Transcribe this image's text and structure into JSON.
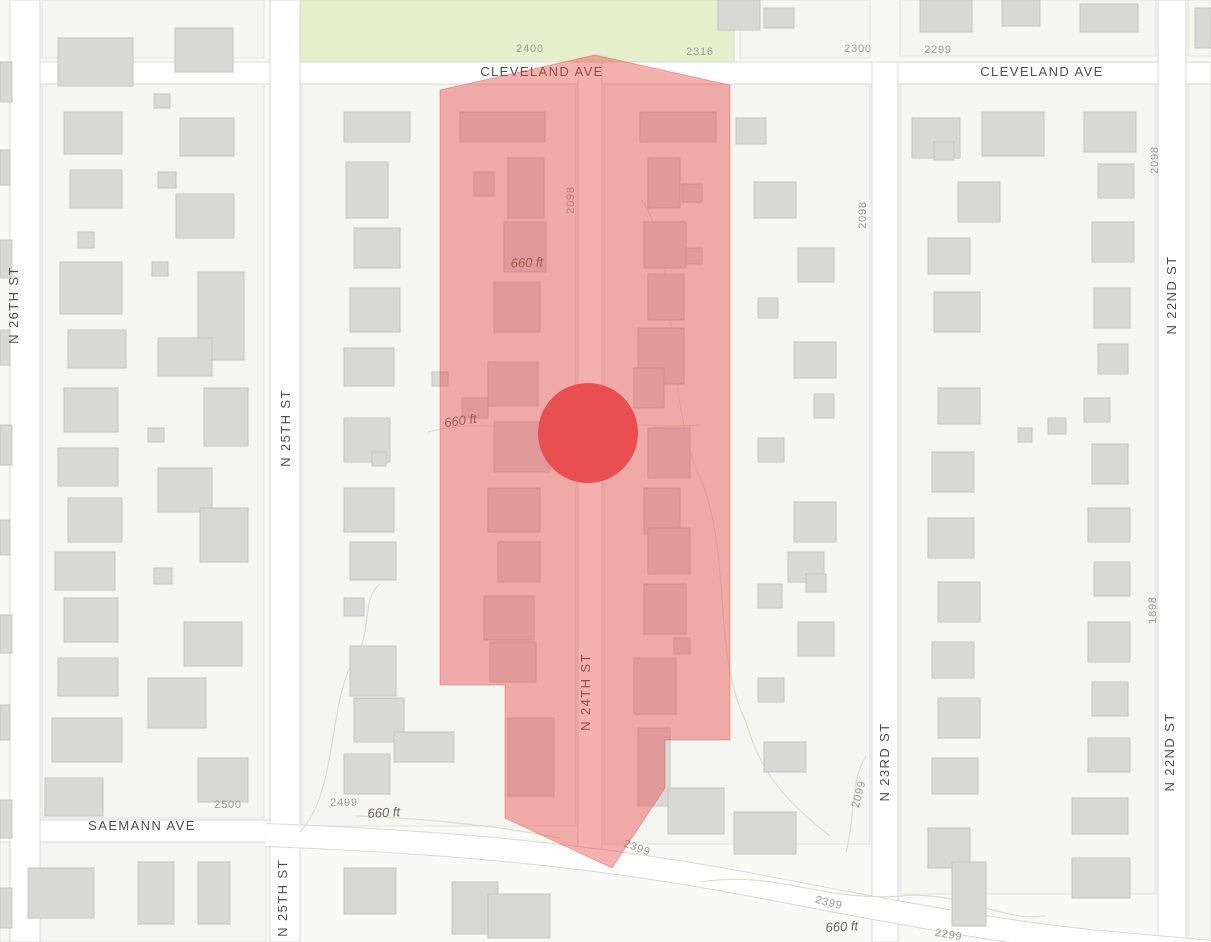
{
  "map": {
    "title": "parcel-map-viewport",
    "width": 1211,
    "height": 942,
    "colors": {
      "background": "#f9f9f6",
      "block_fill": "#f5f5f1",
      "block_border": "#e1e1dd",
      "street_fill": "#ffffff",
      "street_border": "#d8d8d4",
      "building_fill": "#d8d8d7",
      "building_border": "#c3c3c1",
      "green_fill": "#e5eecd",
      "green_border": "#d2ddc0",
      "contour": "#e0dbc6",
      "highlight_fill": "rgba(232,75,75,0.44)",
      "highlight_border": "rgba(220,60,60,0.35)",
      "marker_fill": "#e94e50"
    },
    "green_area": {
      "x": 294,
      "y": 0,
      "w": 440,
      "h": 62
    },
    "blocks": [
      [
        42,
        0,
        222,
        58
      ],
      [
        900,
        0,
        256,
        56
      ],
      [
        1188,
        0,
        23,
        56
      ],
      [
        740,
        0,
        130,
        58
      ],
      [
        42,
        84,
        222,
        734
      ],
      [
        302,
        84,
        274,
        742
      ],
      [
        604,
        84,
        266,
        760
      ],
      [
        900,
        84,
        256,
        810
      ],
      [
        1188,
        84,
        23,
        858
      ],
      [
        0,
        842,
        266,
        100
      ]
    ],
    "streets": {
      "bands": [
        {
          "name": "cleveland-ave",
          "x": 0,
          "y": 62,
          "w": 1211,
          "h": 22
        },
        {
          "name": "saemann-ave",
          "x": 0,
          "y": 820,
          "w": 270,
          "h": 22
        },
        {
          "name": "n-26th-st",
          "x": 10,
          "y": 0,
          "w": 30,
          "h": 942
        },
        {
          "name": "n-25th-st",
          "x": 270,
          "y": 0,
          "w": 30,
          "h": 942
        },
        {
          "name": "n-24th-st",
          "x": 578,
          "y": 62,
          "w": 24,
          "h": 795
        },
        {
          "name": "n-23rd-st",
          "x": 872,
          "y": 62,
          "w": 26,
          "h": 880
        },
        {
          "name": "n-22nd-st",
          "x": 1158,
          "y": 0,
          "w": 28,
          "h": 942
        }
      ],
      "diagonal_path": "M 266 835 C 420 841 560 851 720 879 C 840 901 960 927 1090 941 L 1211 952"
    },
    "contours": [
      "M 300 832 C 338 792 328 702 354 660 C 374 630 360 600 380 584",
      "M 428 432 C 470 420 525 430 565 424 C 610 418 650 430 700 425",
      "M 642 200 C 682 262 662 400 702 482 C 732 562 712 652 746 722 C 760 772 786 802 830 836",
      "M 700 882 C 780 870 820 902 900 896 C 960 890 1000 922 1045 916",
      "M 356 816 C 420 818 500 826 560 838",
      "M 846 852 C 856 812 850 782 866 756"
    ],
    "buildings": [
      [
        0,
        62,
        12,
        40
      ],
      [
        0,
        150,
        10,
        35
      ],
      [
        0,
        240,
        12,
        38
      ],
      [
        0,
        330,
        10,
        35
      ],
      [
        0,
        425,
        12,
        40
      ],
      [
        0,
        520,
        10,
        35
      ],
      [
        0,
        615,
        12,
        38
      ],
      [
        0,
        705,
        10,
        35
      ],
      [
        0,
        800,
        12,
        38
      ],
      [
        0,
        888,
        12,
        40
      ],
      [
        58,
        38,
        75,
        48
      ],
      [
        64,
        112,
        58,
        42
      ],
      [
        70,
        170,
        52,
        38
      ],
      [
        78,
        232,
        16,
        16
      ],
      [
        60,
        262,
        62,
        52
      ],
      [
        68,
        330,
        58,
        38
      ],
      [
        64,
        388,
        54,
        44
      ],
      [
        58,
        448,
        60,
        38
      ],
      [
        68,
        498,
        54,
        44
      ],
      [
        55,
        552,
        60,
        38
      ],
      [
        64,
        598,
        54,
        44
      ],
      [
        58,
        658,
        60,
        38
      ],
      [
        52,
        718,
        70,
        44
      ],
      [
        45,
        778,
        58,
        38
      ],
      [
        175,
        28,
        58,
        44
      ],
      [
        154,
        94,
        16,
        14
      ],
      [
        180,
        118,
        54,
        38
      ],
      [
        158,
        172,
        18,
        16
      ],
      [
        176,
        194,
        58,
        44
      ],
      [
        152,
        262,
        16,
        14
      ],
      [
        198,
        272,
        46,
        88
      ],
      [
        158,
        338,
        54,
        38
      ],
      [
        204,
        388,
        44,
        58
      ],
      [
        148,
        428,
        16,
        14
      ],
      [
        158,
        468,
        54,
        44
      ],
      [
        200,
        508,
        48,
        54
      ],
      [
        154,
        568,
        18,
        16
      ],
      [
        184,
        622,
        58,
        44
      ],
      [
        148,
        678,
        58,
        50
      ],
      [
        198,
        758,
        50,
        44
      ],
      [
        344,
        112,
        66,
        30
      ],
      [
        346,
        162,
        42,
        56
      ],
      [
        354,
        228,
        46,
        40
      ],
      [
        350,
        288,
        50,
        44
      ],
      [
        344,
        348,
        50,
        38
      ],
      [
        432,
        372,
        16,
        14
      ],
      [
        344,
        418,
        46,
        44
      ],
      [
        372,
        452,
        14,
        14
      ],
      [
        344,
        488,
        50,
        44
      ],
      [
        350,
        542,
        46,
        38
      ],
      [
        344,
        598,
        20,
        18
      ],
      [
        350,
        646,
        46,
        50
      ],
      [
        354,
        698,
        50,
        44
      ],
      [
        394,
        732,
        60,
        30
      ],
      [
        344,
        754,
        46,
        40
      ],
      [
        460,
        112,
        85,
        30
      ],
      [
        474,
        172,
        20,
        24
      ],
      [
        508,
        158,
        36,
        60
      ],
      [
        504,
        222,
        42,
        50
      ],
      [
        494,
        282,
        46,
        50
      ],
      [
        462,
        398,
        26,
        20
      ],
      [
        488,
        362,
        50,
        44
      ],
      [
        494,
        422,
        56,
        50
      ],
      [
        488,
        488,
        52,
        44
      ],
      [
        498,
        542,
        42,
        40
      ],
      [
        484,
        596,
        50,
        44
      ],
      [
        490,
        642,
        46,
        40
      ],
      [
        508,
        718,
        46,
        78
      ],
      [
        640,
        112,
        76,
        30
      ],
      [
        648,
        158,
        32,
        50
      ],
      [
        682,
        184,
        20,
        18
      ],
      [
        644,
        222,
        42,
        46
      ],
      [
        686,
        248,
        16,
        16
      ],
      [
        648,
        274,
        36,
        46
      ],
      [
        638,
        328,
        46,
        56
      ],
      [
        634,
        368,
        30,
        40
      ],
      [
        648,
        428,
        42,
        50
      ],
      [
        644,
        488,
        36,
        46
      ],
      [
        648,
        528,
        42,
        46
      ],
      [
        644,
        584,
        42,
        50
      ],
      [
        674,
        638,
        16,
        16
      ],
      [
        634,
        658,
        42,
        56
      ],
      [
        638,
        728,
        32,
        78
      ],
      [
        736,
        118,
        30,
        26
      ],
      [
        754,
        182,
        42,
        36
      ],
      [
        798,
        248,
        36,
        34
      ],
      [
        758,
        298,
        20,
        20
      ],
      [
        794,
        342,
        42,
        36
      ],
      [
        814,
        394,
        20,
        24
      ],
      [
        758,
        438,
        26,
        24
      ],
      [
        794,
        502,
        42,
        40
      ],
      [
        788,
        552,
        36,
        30
      ],
      [
        806,
        574,
        20,
        18
      ],
      [
        758,
        584,
        24,
        24
      ],
      [
        798,
        622,
        36,
        34
      ],
      [
        758,
        678,
        26,
        24
      ],
      [
        764,
        742,
        42,
        30
      ],
      [
        734,
        812,
        62,
        42
      ],
      [
        668,
        788,
        56,
        46
      ],
      [
        912,
        118,
        48,
        40
      ],
      [
        934,
        142,
        20,
        18
      ],
      [
        982,
        112,
        62,
        44
      ],
      [
        958,
        182,
        42,
        40
      ],
      [
        928,
        238,
        42,
        36
      ],
      [
        934,
        292,
        46,
        40
      ],
      [
        938,
        388,
        42,
        36
      ],
      [
        932,
        452,
        42,
        40
      ],
      [
        928,
        518,
        46,
        40
      ],
      [
        938,
        582,
        42,
        40
      ],
      [
        932,
        642,
        42,
        36
      ],
      [
        938,
        698,
        42,
        40
      ],
      [
        932,
        758,
        46,
        36
      ],
      [
        928,
        828,
        42,
        40
      ],
      [
        952,
        862,
        34,
        64
      ],
      [
        1084,
        112,
        52,
        40
      ],
      [
        1098,
        164,
        36,
        34
      ],
      [
        1092,
        222,
        42,
        40
      ],
      [
        1094,
        288,
        36,
        40
      ],
      [
        1098,
        344,
        30,
        30
      ],
      [
        1084,
        398,
        26,
        24
      ],
      [
        1048,
        418,
        18,
        16
      ],
      [
        1018,
        428,
        14,
        14
      ],
      [
        1092,
        444,
        36,
        40
      ],
      [
        1088,
        508,
        42,
        34
      ],
      [
        1094,
        562,
        36,
        34
      ],
      [
        1088,
        622,
        42,
        40
      ],
      [
        1092,
        682,
        36,
        34
      ],
      [
        1088,
        738,
        42,
        34
      ],
      [
        1072,
        798,
        56,
        36
      ],
      [
        718,
        0,
        42,
        30
      ],
      [
        764,
        8,
        30,
        20
      ],
      [
        920,
        0,
        52,
        32
      ],
      [
        1002,
        0,
        38,
        26
      ],
      [
        1080,
        4,
        58,
        28
      ],
      [
        1195,
        8,
        16,
        40
      ],
      [
        28,
        868,
        66,
        50
      ],
      [
        138,
        862,
        36,
        62
      ],
      [
        198,
        862,
        32,
        62
      ],
      [
        344,
        868,
        52,
        46
      ],
      [
        452,
        882,
        46,
        52
      ],
      [
        488,
        894,
        62,
        44
      ],
      [
        1072,
        858,
        58,
        40
      ]
    ],
    "highlight_zone": {
      "points": "595,55 730,85 730,740 665,740 665,788 612,868 505,818 505,685 440,685 440,90"
    },
    "marker": {
      "cx": 588,
      "cy": 433,
      "r": 50
    },
    "labels": [
      {
        "text": "2400",
        "x": 530,
        "y": 52,
        "rot": 0,
        "cls": "lbl-num",
        "name": "block-number-2400"
      },
      {
        "text": "2316",
        "x": 700,
        "y": 55,
        "rot": 0,
        "cls": "lbl-num",
        "name": "block-number-2316"
      },
      {
        "text": "CLEVELAND AVE",
        "x": 542,
        "y": 76,
        "rot": 0,
        "cls": "lbl-street",
        "name": "street-label-cleveland-ave-west"
      },
      {
        "text": "2300",
        "x": 858,
        "y": 52,
        "rot": 0,
        "cls": "lbl-num",
        "name": "block-number-2300"
      },
      {
        "text": "2299",
        "x": 938,
        "y": 53,
        "rot": 0,
        "cls": "lbl-num",
        "name": "block-number-2299-top"
      },
      {
        "text": "CLEVELAND AVE",
        "x": 1042,
        "y": 76,
        "rot": 0,
        "cls": "lbl-street",
        "name": "street-label-cleveland-ave-east"
      },
      {
        "text": "N 26TH ST",
        "x": 18,
        "y": 305,
        "rot": -90,
        "cls": "lbl-street",
        "name": "street-label-n-26th-st"
      },
      {
        "text": "2098",
        "x": 574,
        "y": 200,
        "rot": -90,
        "cls": "lbl-num",
        "name": "block-number-2098-center"
      },
      {
        "text": "2098",
        "x": 866,
        "y": 215,
        "rot": -90,
        "cls": "lbl-num",
        "name": "block-number-2098-mid"
      },
      {
        "text": "2098",
        "x": 1158,
        "y": 160,
        "rot": -90,
        "cls": "lbl-num",
        "name": "block-number-2098-right"
      },
      {
        "text": "N 22ND ST",
        "x": 1176,
        "y": 295,
        "rot": -90,
        "cls": "lbl-street",
        "name": "street-label-n-22nd-st-upper"
      },
      {
        "text": "660 ft",
        "x": 527,
        "y": 267,
        "rot": -2,
        "cls": "lbl-contour",
        "name": "contour-label-660ft-a"
      },
      {
        "text": "N 25TH ST",
        "x": 290,
        "y": 428,
        "rot": -90,
        "cls": "lbl-street",
        "name": "street-label-n-25th-st-upper"
      },
      {
        "text": "660 ft",
        "x": 461,
        "y": 425,
        "rot": -8,
        "cls": "lbl-contour",
        "name": "contour-label-660ft-b"
      },
      {
        "text": "N 24TH ST",
        "x": 590,
        "y": 692,
        "rot": -90,
        "cls": "lbl-street",
        "name": "street-label-n-24th-st"
      },
      {
        "text": "1898",
        "x": 1156,
        "y": 610,
        "rot": -90,
        "cls": "lbl-num",
        "name": "block-number-1898"
      },
      {
        "text": "N 22ND ST",
        "x": 1174,
        "y": 752,
        "rot": -90,
        "cls": "lbl-street",
        "name": "street-label-n-22nd-st-lower"
      },
      {
        "text": "N 23RD ST",
        "x": 889,
        "y": 762,
        "rot": -90,
        "cls": "lbl-street",
        "name": "street-label-n-23rd-st"
      },
      {
        "text": "2099",
        "x": 862,
        "y": 795,
        "rot": -75,
        "cls": "lbl-num",
        "name": "block-number-2099"
      },
      {
        "text": "2500",
        "x": 228,
        "y": 808,
        "rot": 0,
        "cls": "lbl-num",
        "name": "block-number-2500"
      },
      {
        "text": "SAEMANN AVE",
        "x": 142,
        "y": 830,
        "rot": 0,
        "cls": "lbl-street",
        "name": "street-label-saemann-ave"
      },
      {
        "text": "2499",
        "x": 344,
        "y": 806,
        "rot": 0,
        "cls": "lbl-num",
        "name": "block-number-2499"
      },
      {
        "text": "660 ft",
        "x": 384,
        "y": 817,
        "rot": -3,
        "cls": "lbl-contour",
        "name": "contour-label-660ft-c"
      },
      {
        "text": "2399",
        "x": 636,
        "y": 851,
        "rot": 20,
        "cls": "lbl-num",
        "name": "block-number-2399-upper"
      },
      {
        "text": "N 25TH ST",
        "x": 287,
        "y": 898,
        "rot": -90,
        "cls": "lbl-street",
        "name": "street-label-n-25th-st-lower"
      },
      {
        "text": "2399",
        "x": 828,
        "y": 906,
        "rot": 14,
        "cls": "lbl-num",
        "name": "block-number-2399-lower"
      },
      {
        "text": "660 ft",
        "x": 842,
        "y": 931,
        "rot": -3,
        "cls": "lbl-contour",
        "name": "contour-label-660ft-d"
      },
      {
        "text": "2299",
        "x": 948,
        "y": 938,
        "rot": 10,
        "cls": "lbl-num",
        "name": "block-number-2299-bottom"
      }
    ]
  }
}
